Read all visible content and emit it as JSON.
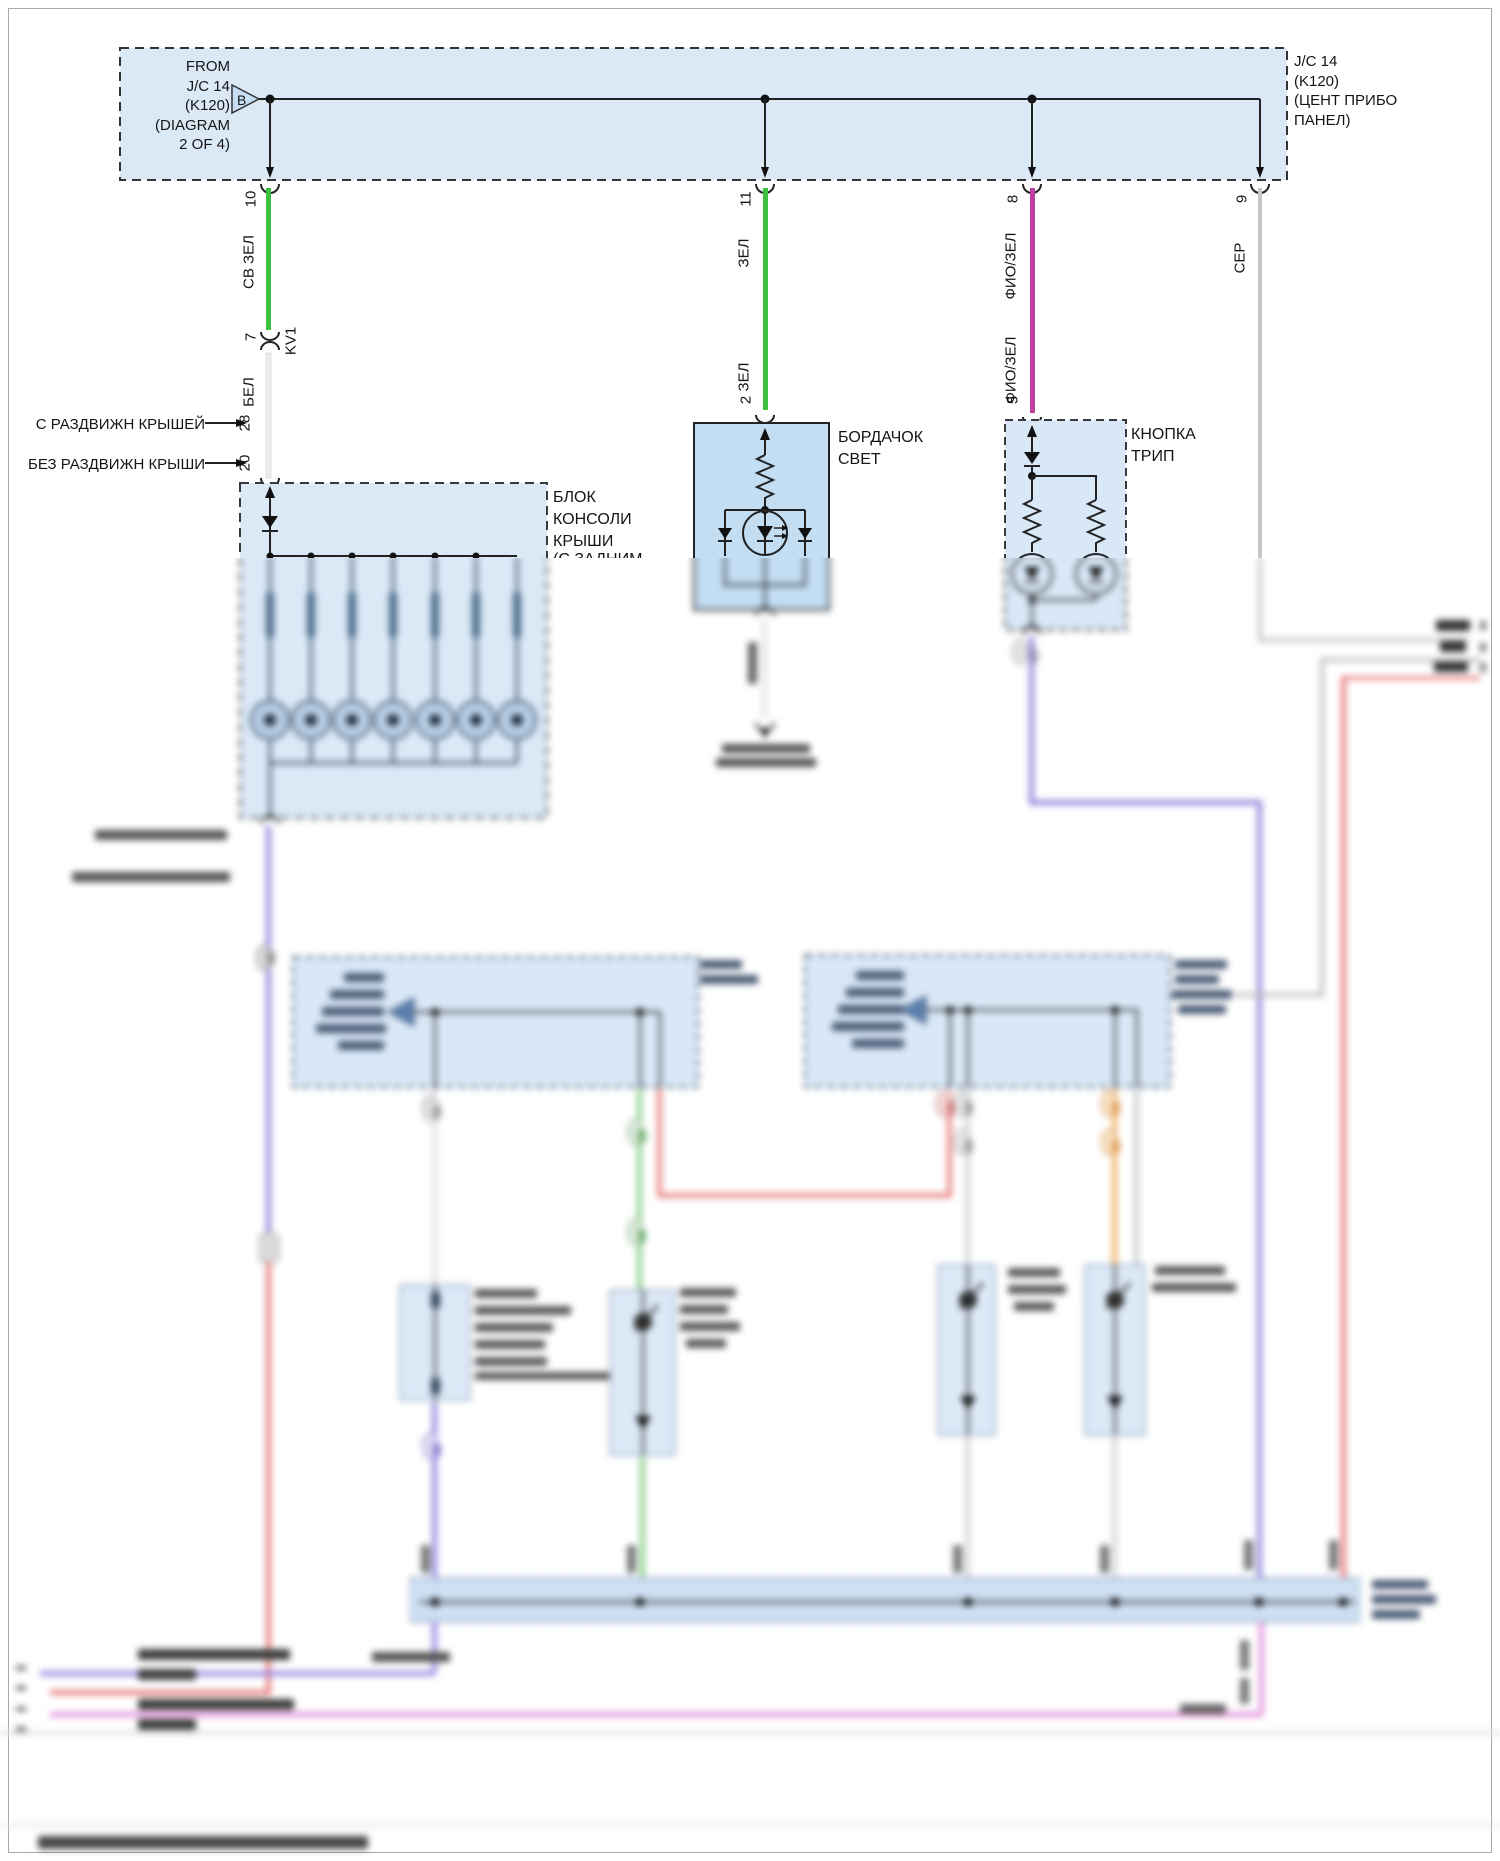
{
  "junction_box": {
    "from_label": "FROM\nJ/C 14\n(K120)\n(DIAGRAM\n2 OF 4)",
    "triangle_letter": "B",
    "name_label": "J/C 14\n(K120)\n(ЦЕНТ ПРИБО\nПАНЕЛ)"
  },
  "wires": {
    "w1": {
      "pin_top": "10",
      "color_top": "СВ ЗЕЛ",
      "inline_pin": "7",
      "inline_connector": "KV1",
      "color_bottom": "БЕЛ",
      "options": [
        {
          "label": "С РАЗДВИЖН КРЫШЕЙ",
          "pin": "28"
        },
        {
          "label": "БЕЗ РАЗДВИЖН КРЫШИ",
          "pin": "20"
        }
      ]
    },
    "w2": {
      "pin_top": "11",
      "color_upper": "ЗЕЛ",
      "color_lower": "ЗЕЛ",
      "pin_bottom": "2"
    },
    "w3": {
      "pin_top": "8",
      "color_upper": "ФИО/ЗЕЛ",
      "color_lower": "ФИО/ЗЕЛ",
      "pin_bottom": "5"
    },
    "w4": {
      "pin_top": "9",
      "color_label": "СЕР"
    }
  },
  "components": {
    "roof_console": {
      "label": "БЛОК\nКОНСОЛИ\nКРЫШИ",
      "sub_label": "(С ЗАДНИМ"
    },
    "glovebox_light": {
      "label": "БОРДАЧОК\nСВЕТ"
    },
    "trip_button": {
      "label": "КНОПКА\nТРИП"
    }
  },
  "colors": {
    "box_fill": "#dbe9f7",
    "glovebox_fill": "#c3ddf3",
    "bus_fill": "#cddff2",
    "wire_green": "#3cc13c",
    "wire_magenta": "#c23da0",
    "wire_gray": "#c6c6c6",
    "wire_white": "#ececec",
    "wire_purple": "#9488dd",
    "wire_red": "#e87f7f",
    "wire_orange": "#f2b26b",
    "wire_pink": "#e596dd",
    "wire_black": "#222222"
  }
}
